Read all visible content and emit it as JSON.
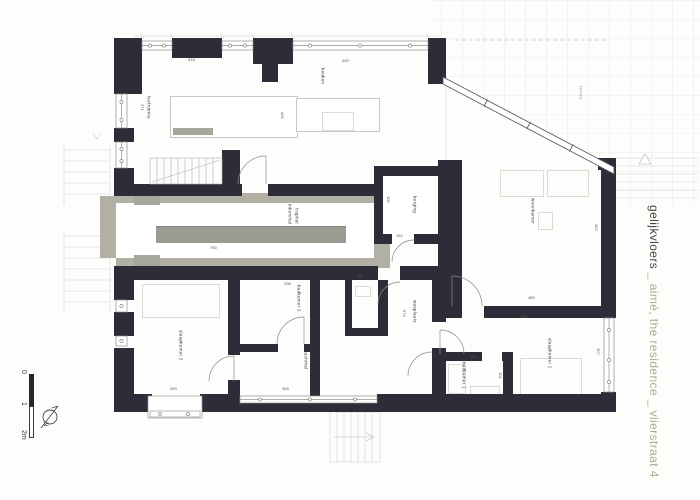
{
  "sidebar": {
    "primary": "gelijkvloers",
    "secondary": " _ aimé, the residence _ vlierstraat 4"
  },
  "scalebar": {
    "zero": "0",
    "one": "1",
    "two": "2m",
    "north": "N"
  },
  "rooms": {
    "leefruimte": "leefruimte",
    "keuken": "keuken",
    "terras": "terras",
    "woonkamer": "woonkamer",
    "berging": "berging",
    "inkomhal": "inkomhal",
    "traphal": "traphal",
    "slaapkamer2": "slaapkamer 2",
    "badkamer2": "badkamer 2",
    "nachthal": "nachthal",
    "wasplaats": "wasplaats",
    "badkamer1": "badkamer 1",
    "slaapkamer1": "slaapkamer 1"
  },
  "dims": {
    "top_left": "416",
    "top_mid": "400",
    "left_room_h": "371",
    "kitchen_h": "429",
    "corridor": "750",
    "berging_w": "152",
    "berging_h": "100",
    "badkamer2_w": "208",
    "wc_w": "96",
    "slaapkamer2_w": "290",
    "nachthal_w": "308",
    "woonkamer_w": "480",
    "slaapkamer1_w": "148",
    "badkamer1_w": "184",
    "slaapkamer1_h": "307",
    "woonkamer_h": "493",
    "hall_h": "574",
    "badkamer1_h": "101"
  },
  "colors": {
    "wall": "#2d2d39",
    "corridor_gray": "#b2b0a5",
    "title_primary": "#4b4741",
    "title_secondary": "#b3aa8e"
  }
}
